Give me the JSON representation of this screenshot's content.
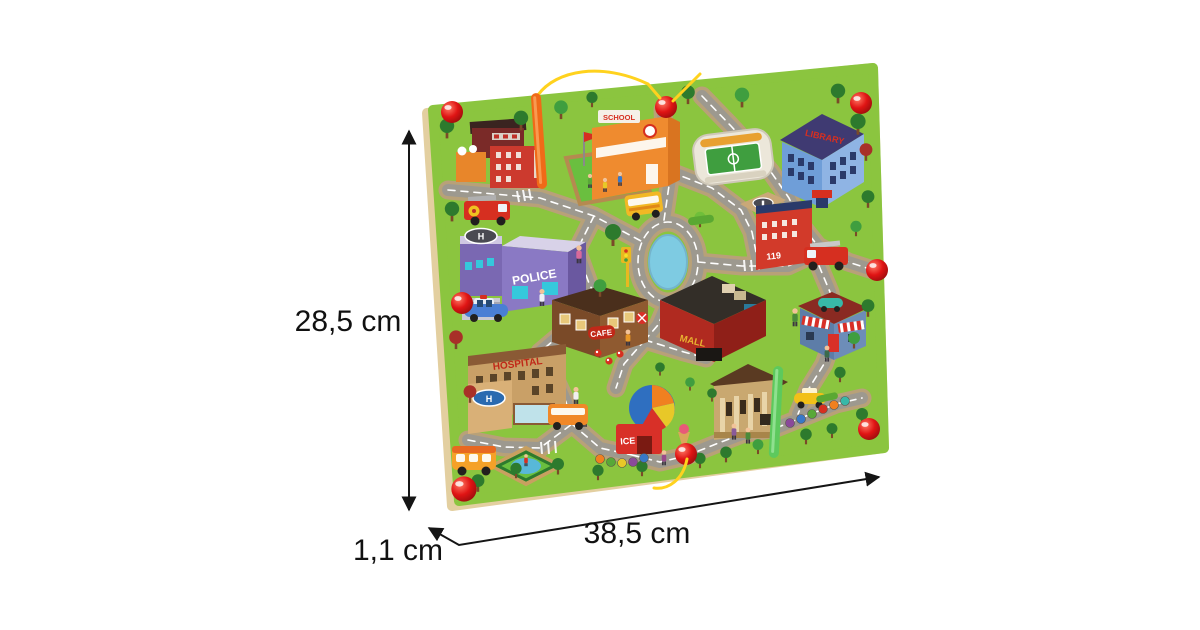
{
  "annotations": {
    "height_label": "28,5 cm",
    "width_label": "38,5 cm",
    "thickness_label": "1,1 cm",
    "arrow_color": "#1a1a1a"
  },
  "board": {
    "colors": {
      "surface_green": "#8bc53f",
      "wood_edge": "#e3cfa0",
      "road_gray": "#9d998f",
      "road_border_tan": "#b8a178",
      "pond_blue": "#7ecbe2",
      "magnet_ball_red": "#e01414",
      "pen_orange": "#f06a18",
      "pen_green": "#5dc95d",
      "string_yellow": "#ffd21e"
    },
    "signs": {
      "police": "POLICE",
      "hospital": "HOSPITAL",
      "cafe": "CAFE",
      "mall": "MALL",
      "ice_cream": "ICE",
      "school": "SCHOOL",
      "library": "LIBRARY",
      "fire_station_number": "119"
    }
  }
}
